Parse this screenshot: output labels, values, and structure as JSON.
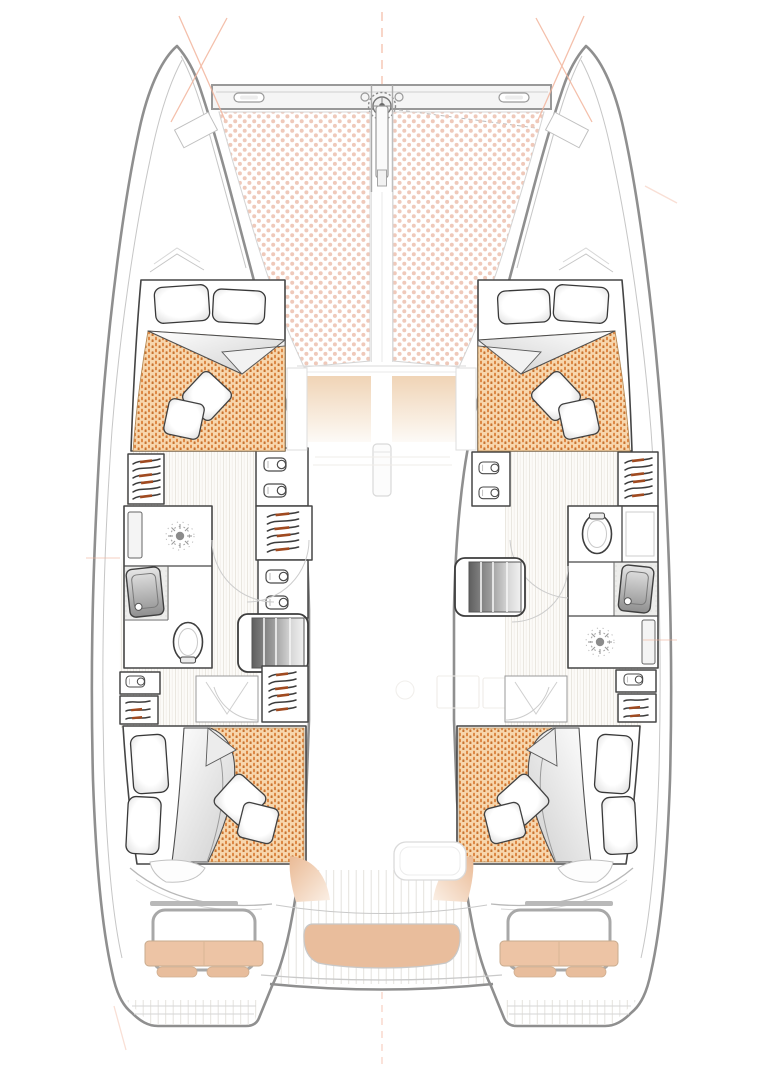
{
  "plan": {
    "kind": "catamaran-deck-floorplan",
    "cabins_drawn": 4,
    "heads_drawn": 2,
    "trampoline_panels": 2
  },
  "colors": {
    "hull_outline": "#8f8f8f",
    "interior_wall": "#474747",
    "construction_line": "#f2b49c",
    "trampoline_dot": "#efc9ba",
    "duvet_base": "#f7d6ad",
    "duvet_stitch_a": "#dd8743",
    "duvet_stitch_b": "#c9732f",
    "hanger_accent": "#a04a20",
    "bench_cushion": "#e9bd9c",
    "seat_back_cushion": "#edc4a5",
    "seat_pad": "#e8bd9c",
    "foredeck_pad": "#f0d4b6",
    "steps_dark": "#5f5f5f",
    "wood_line": "#e9e5de",
    "teak_line": "#e4e2dd",
    "tile_floor": "#ededeb"
  },
  "icons": [
    "windlass-icon",
    "cleat-icon",
    "bowsprit-icon",
    "trampoline-pattern",
    "mast-icon",
    "shower-drain-icon",
    "toilet-icon",
    "sink-icon",
    "faucet-icon",
    "hanger-icon",
    "shirt-icon",
    "companionway-steps-icon",
    "hatch-icon",
    "helm-seat-icon",
    "pillow-icon",
    "cushion-icon",
    "door-swing-icon"
  ]
}
